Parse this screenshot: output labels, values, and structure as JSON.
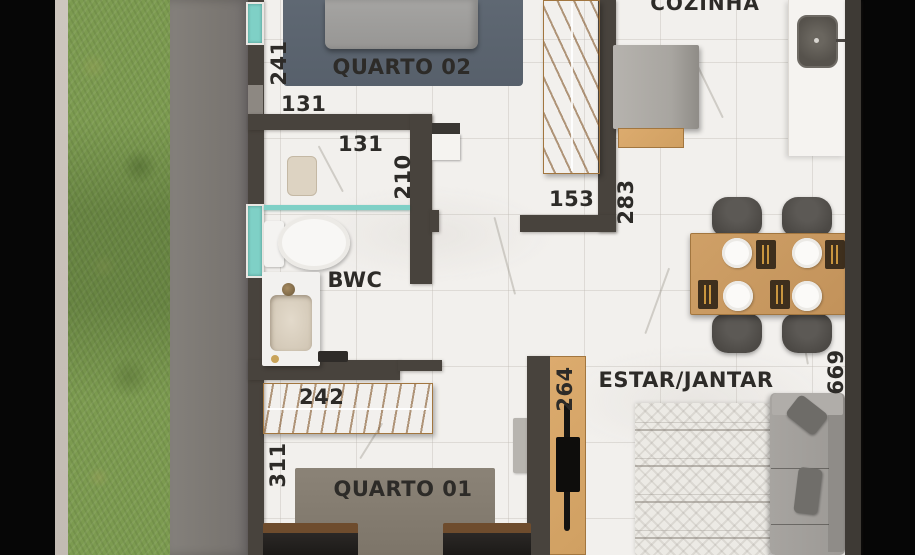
{
  "plan": {
    "view": "top-down rendered floor plan",
    "room_labels": {
      "kitchen": "COZINHA",
      "bedroom2": "QUARTO 02",
      "bathroom": "BWC",
      "bedroom1": "QUARTO 01",
      "living_dining": "ESTAR/JANTAR"
    },
    "dimensions": {
      "d241": "241",
      "d131_hall": "131",
      "d131_bath": "131",
      "d210": "210",
      "d153": "153",
      "d283": "283",
      "d242": "242",
      "d311": "311",
      "d264": "264",
      "d669": "669"
    },
    "palette": {
      "wall": "#48433d",
      "wood": "#d7a76b",
      "window_glass": "#7fd0c6",
      "grass": "#7c9b50",
      "concrete": "#7b7772",
      "marble_floor": "#f2f0ed",
      "label_text": "#2d2b28"
    }
  }
}
